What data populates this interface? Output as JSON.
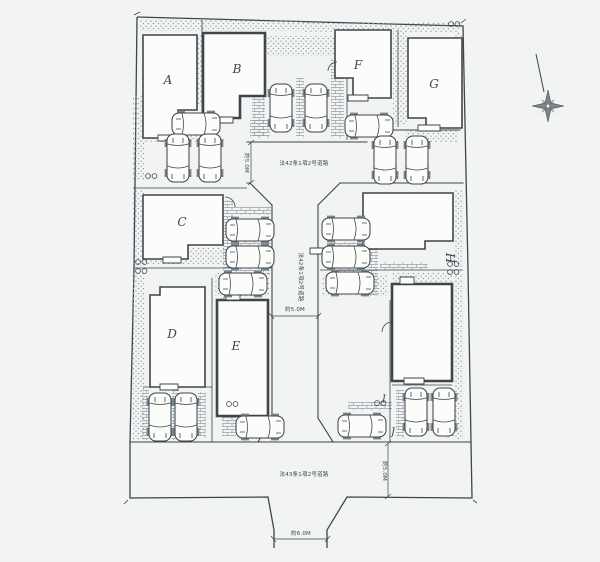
{
  "colors": {
    "paper": "#f2f4f3",
    "ink": "#3e454b",
    "ink_light": "#7c858c",
    "texture": "#96a0a7",
    "building_fill": "#fcfcfb"
  },
  "buildings": {
    "a": "A",
    "b": "B",
    "c": "C",
    "d": "D",
    "e": "E",
    "f": "F",
    "g": "G",
    "h": "H",
    "i": "I",
    "j": "J"
  },
  "roads": {
    "top_name": "法42条1項2号道路",
    "center_name": "法42条1項2号道路",
    "bottom_name": "法43条1項2号道路"
  },
  "dimensions": {
    "top_road_width": "約5.0M",
    "center_road_width": "約5.0M",
    "bottom_road_width": "約5.0M",
    "entrance_width": "約6.0M"
  },
  "icons": {
    "compass": "north-compass-star",
    "car": "car-top-view"
  }
}
